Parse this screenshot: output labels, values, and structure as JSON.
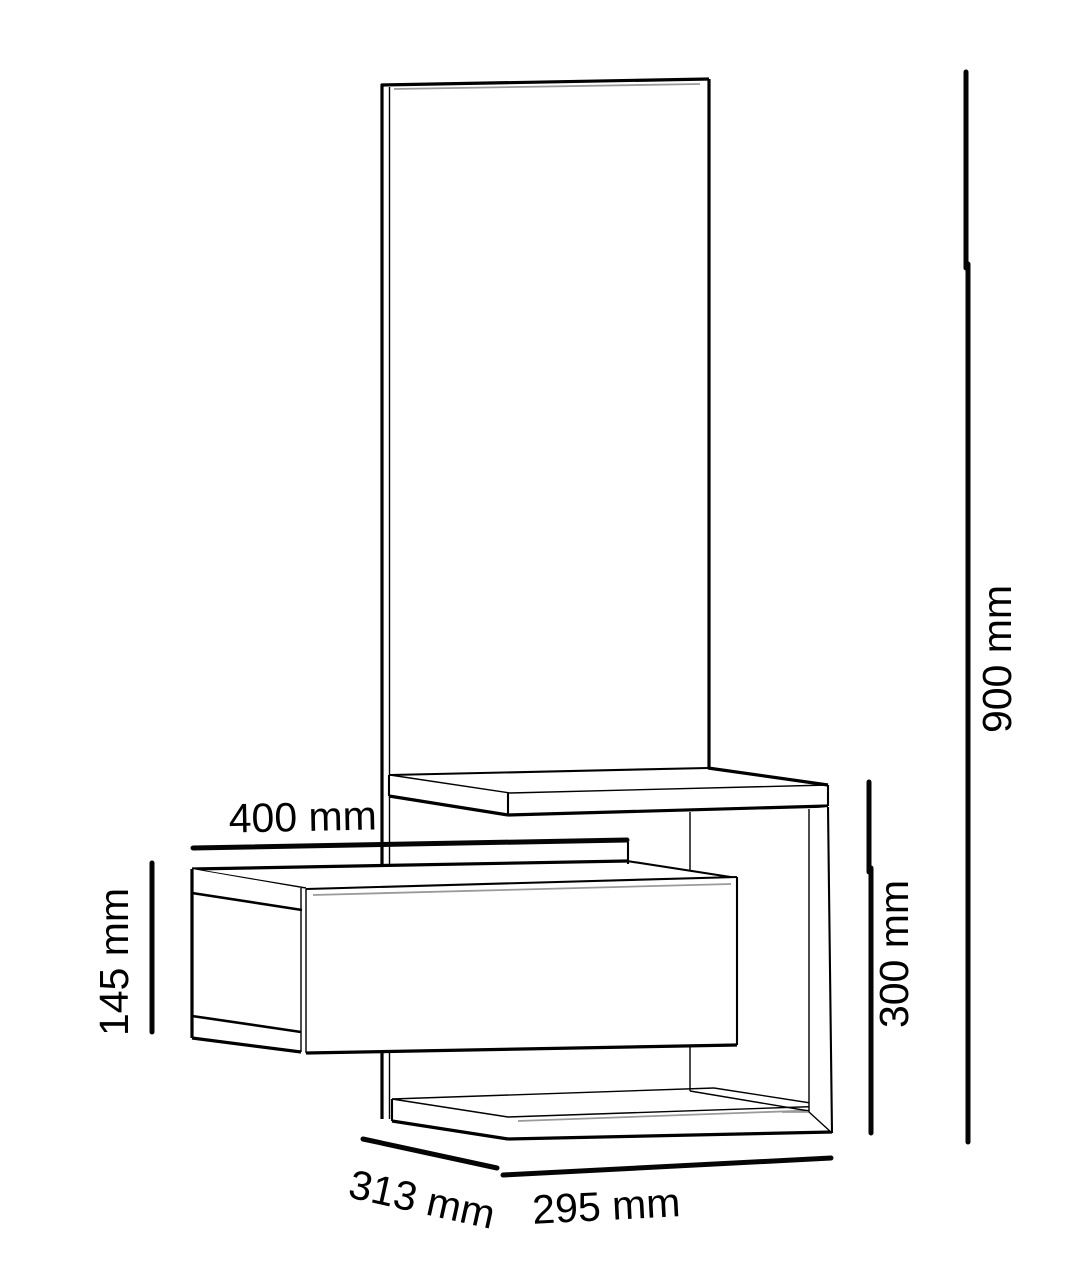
{
  "colors": {
    "background": "#ffffff",
    "line": "#000000",
    "shade": "#9a9a9a"
  },
  "unit": "mm",
  "measurements": {
    "m400": {
      "text": "400 mm",
      "value": 400,
      "unit": "mm"
    },
    "m145": {
      "text": "145 mm",
      "value": 145,
      "unit": "mm"
    },
    "m900": {
      "text": "900 mm",
      "value": 900,
      "unit": "mm"
    },
    "m300": {
      "text": "300 mm",
      "value": 300,
      "unit": "mm"
    },
    "m313": {
      "text": "313 mm",
      "value": 313,
      "unit": "mm"
    },
    "m295": {
      "text": "295 mm",
      "value": 295,
      "unit": "mm"
    }
  }
}
